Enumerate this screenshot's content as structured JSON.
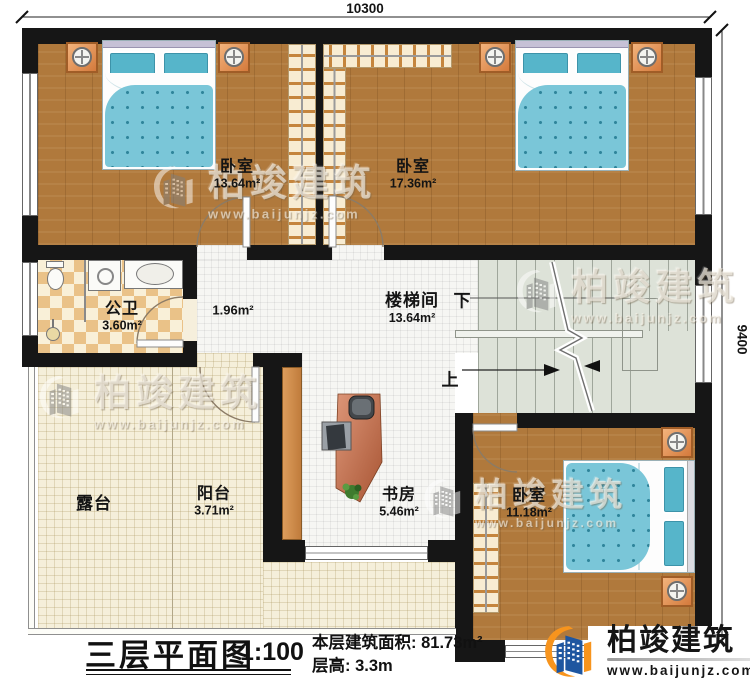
{
  "dimensions": {
    "top_width": "10300",
    "right_height": "9400"
  },
  "rooms": {
    "bedroom_top_left": {
      "name": "卧室",
      "area": "13.64m²"
    },
    "bedroom_top_right": {
      "name": "卧室",
      "area": "17.36m²"
    },
    "bathroom": {
      "name": "公卫",
      "area": "3.60m²"
    },
    "hallway": {
      "area": "1.96m²"
    },
    "stairwell": {
      "name": "楼梯间",
      "area": "13.64m²",
      "down_label": "下",
      "up_label": "上"
    },
    "terrace": {
      "name": "露台"
    },
    "balcony": {
      "name": "阳台",
      "area": "3.71m²"
    },
    "study": {
      "name": "书房",
      "area": "5.46m²"
    },
    "bedroom_bottom_right": {
      "name": "卧室",
      "area": "11.18m²"
    }
  },
  "title_block": {
    "title": "三层平面图",
    "scale": "1:100",
    "floor_area_label": "本层建筑面积:",
    "floor_area_value": "81.73m²",
    "floor_height_label": "层高:",
    "floor_height_value": "3.3m"
  },
  "brand": {
    "name": "柏竣建筑",
    "website": "www.baijunjz.com"
  },
  "watermark": {
    "name": "柏竣建筑",
    "website": "www.baijunjz.com"
  },
  "colors": {
    "wall": "#161616",
    "wood_floor": "#b0793c",
    "bed_teal": "#7ac6d8",
    "tile_cream": "#f5efda",
    "stairs_sage": "#dde2d8",
    "brand_blue": "#1e56a0",
    "brand_orange": "#f7941d"
  }
}
